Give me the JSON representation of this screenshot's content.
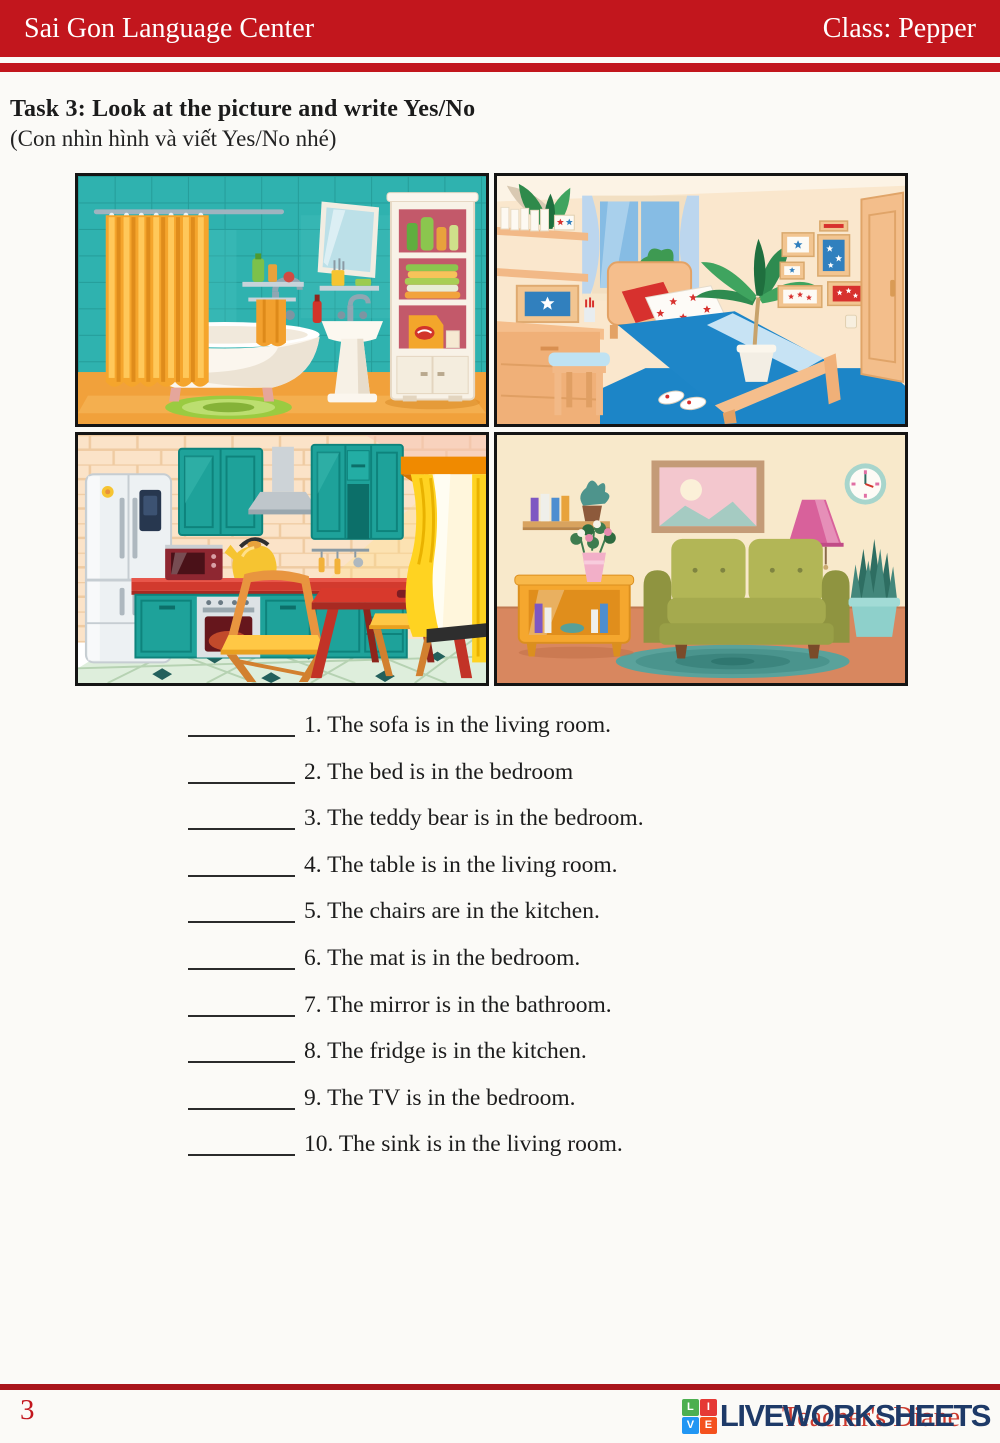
{
  "header": {
    "school": "Sai Gon Language Center",
    "class_label": "Class: Pepper"
  },
  "task": {
    "title": "Task 3: Look at the picture and write Yes/No",
    "subtitle": "(Con nhìn hình và viết Yes/No nhé)"
  },
  "pictures": [
    {
      "position": "top-left",
      "room": "bathroom",
      "icon": "bathroom-illustration"
    },
    {
      "position": "top-right",
      "room": "bedroom",
      "icon": "bedroom-illustration"
    },
    {
      "position": "bottom-left",
      "room": "kitchen",
      "icon": "kitchen-illustration"
    },
    {
      "position": "bottom-right",
      "room": "living room",
      "icon": "living-room-illustration"
    }
  ],
  "questions": [
    {
      "answer": "",
      "text": "1. The sofa is in the living room."
    },
    {
      "answer": "",
      "text": "2. The bed is in the bedroom"
    },
    {
      "answer": "",
      "text": "3. The teddy bear is in the bedroom."
    },
    {
      "answer": "",
      "text": "4. The table is in the living room."
    },
    {
      "answer": "",
      "text": "5. The chairs are in the kitchen."
    },
    {
      "answer": "",
      "text": "6. The mat is in the bedroom."
    },
    {
      "answer": "",
      "text": "7. The mirror is in the bathroom."
    },
    {
      "answer": "",
      "text": "8. The fridge is in the kitchen."
    },
    {
      "answer": "",
      "text": "9. The TV is in the bedroom."
    },
    {
      "answer": "",
      "text": "10. The sink is in the living room."
    }
  ],
  "footer": {
    "page_number": "3",
    "logo_text": "LIVEWORKSHEETS",
    "logo_blocks": [
      "L",
      "I",
      "V",
      "E"
    ],
    "watermark": "Teacher's Diane"
  },
  "colors": {
    "header_red": "#C2161D",
    "footer_line_red": "#A9151B",
    "logo_navy": "#1E3A68",
    "logo_green": "#4CAF50",
    "logo_red": "#E53935",
    "logo_blue": "#2196F3",
    "logo_orange": "#F4511E",
    "body_text": "#1C1C1C"
  }
}
